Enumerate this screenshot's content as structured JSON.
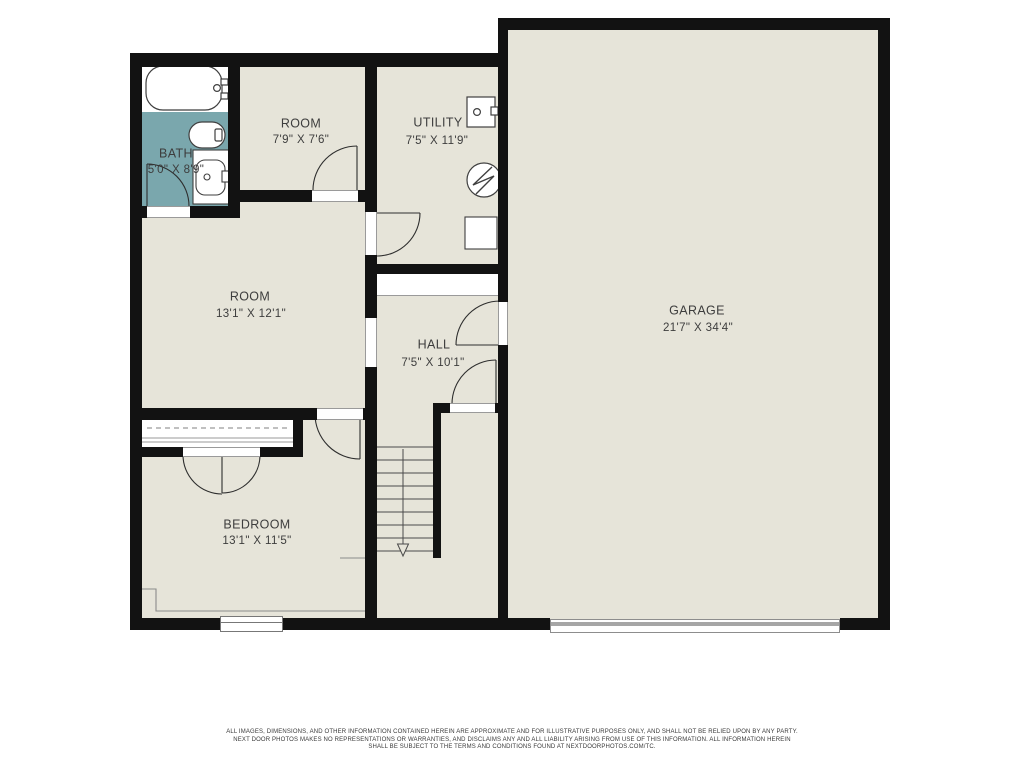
{
  "title": "basement floor plan",
  "colors": {
    "floor": "#e6e4d9",
    "bath": "#7aa7ad",
    "wall": "#121212",
    "fixline": "#3f3f3f",
    "thin": "#8b8b8b",
    "text": "#3d3d3d"
  },
  "rooms": [
    {
      "name": "BATH",
      "dims": "5'0\" X 8'9\""
    },
    {
      "name": "ROOM",
      "dims": "7'9\" X 7'6\""
    },
    {
      "name": "UTILITY",
      "dims": "7'5\" X 11'9\""
    },
    {
      "name": "ROOM",
      "dims": "13'1\" X 12'1\""
    },
    {
      "name": "HALL",
      "dims": "7'5\" X 10'1\""
    },
    {
      "name": "BEDROOM",
      "dims": "13'1\" X 11'5\""
    },
    {
      "name": "GARAGE",
      "dims": "21'7\" X 34'4\""
    }
  ],
  "fixtures": [
    "bathtub",
    "toilet",
    "vanity-sink",
    "washer",
    "water-heater",
    "appliance-box",
    "stairs-down",
    "closet-rod",
    "bedroom-window",
    "garage-door"
  ],
  "disclaimer": [
    "ALL IMAGES, DIMENSIONS, AND OTHER INFORMATION CONTAINED HEREIN ARE APPROXIMATE AND FOR ILLUSTRATIVE PURPOSES ONLY, AND SHALL NOT BE RELIED UPON BY ANY PARTY.",
    "NEXT DOOR PHOTOS MAKES NO REPRESENTATIONS OR WARRANTIES, AND DISCLAIMS ANY AND ALL LIABILITY ARISING FROM USE OF THIS INFORMATION. ALL INFORMATION HEREIN",
    "SHALL BE SUBJECT TO THE TERMS AND CONDITIONS FOUND AT NEXTDOORPHOTOS.COM/TC."
  ]
}
